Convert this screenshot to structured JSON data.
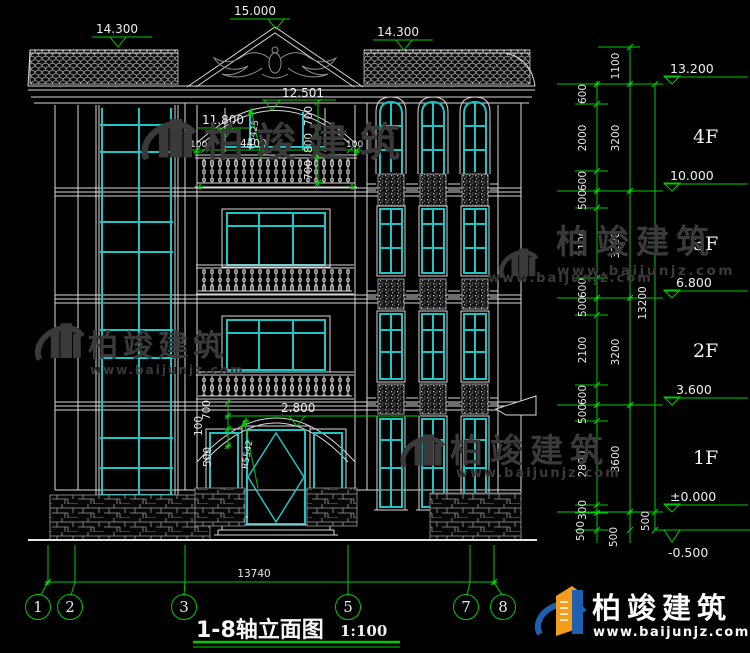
{
  "drawing": {
    "title": "1-8轴立面图",
    "scale": "1:100",
    "overall_width_dim": "13740",
    "axis_bubbles": [
      "1",
      "2",
      "3",
      "5",
      "7",
      "8"
    ],
    "elevations": {
      "ridge": "15.000",
      "left_eave": "14.300",
      "right_eave": "14.300",
      "balcony_arc_top": "12.501",
      "balcony_arc_eave": "11.800",
      "entrance_arch": "2.800",
      "levels": [
        "13.200",
        "10.000",
        "6.800",
        "3.600",
        "±0.000",
        "-0.500"
      ]
    },
    "floors": [
      "4F",
      "3F",
      "2F",
      "1F"
    ],
    "dim_chains": {
      "sub": [
        "600",
        "2000",
        "600",
        "500",
        "2100",
        "600",
        "500",
        "2100",
        "600",
        "500",
        "2800",
        "300",
        "500"
      ],
      "floor": [
        "1100",
        "3200",
        "3200",
        "3200",
        "3600",
        "500"
      ],
      "total": "13200",
      "total_foot": "500"
    },
    "facade_dims": {
      "balcony": [
        "100",
        "4400",
        "100"
      ],
      "arc_vertical": [
        "700",
        "800",
        "700"
      ],
      "balcony_radius": "R3425",
      "entrance_vertical": [
        "700",
        "100",
        "500"
      ],
      "entrance_radius": "R5542"
    },
    "watermark": {
      "brand": "柏竣建筑",
      "url": "www.baijunjz.com"
    },
    "footer": {
      "brand": "柏竣建筑",
      "url": "www.baijunjz.com"
    }
  }
}
